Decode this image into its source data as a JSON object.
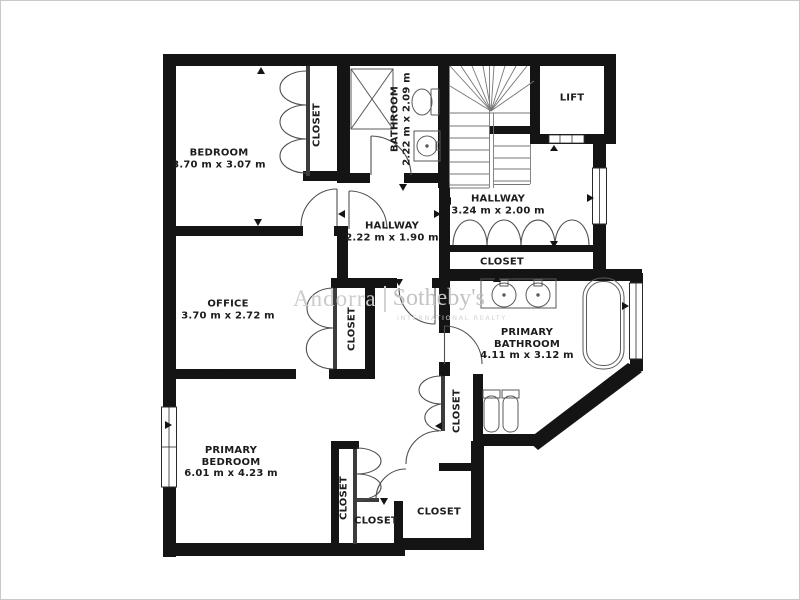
{
  "frame": {
    "background": "#ffffff",
    "border_color": "#c9c9c9",
    "wall_color": "#141414"
  },
  "plan": {
    "rooms": {
      "bedroom": {
        "name": "BEDROOM",
        "dims": "3.70 m x 3.07 m"
      },
      "office": {
        "name": "OFFICE",
        "dims": "3.70 m x 2.72 m"
      },
      "bathroom": {
        "name": "BATHROOM",
        "dims": "2.22 m x 2.09 m"
      },
      "hallway_upper": {
        "name": "HALLWAY",
        "dims": "3.24 m x 2.00 m"
      },
      "hallway_center": {
        "name": "HALLWAY",
        "dims": "2.22 m x 1.90 m"
      },
      "lift": {
        "name": "LIFT"
      },
      "primary_bathroom": {
        "name_line1": "PRIMARY",
        "name_line2": "BATHROOM",
        "dims": "4.11 m x 3.12 m"
      },
      "primary_bedroom": {
        "name_line1": "PRIMARY",
        "name_line2": "BEDROOM",
        "dims": "6.01 m x 4.23 m"
      }
    },
    "closets": {
      "bedroom_closet": "CLOSET",
      "hallway_closet": "CLOSET",
      "office_closet": "CLOSET",
      "corridor_closet": "CLOSET",
      "southeast_closet": "CLOSET",
      "south_small_closet": "CLOSET",
      "south_left_closet": "CLOSET"
    }
  },
  "watermark": {
    "brand_primary": "Andorra",
    "brand_secondary": "Sotheby's",
    "tagline": "INTERNATIONAL REALTY"
  }
}
